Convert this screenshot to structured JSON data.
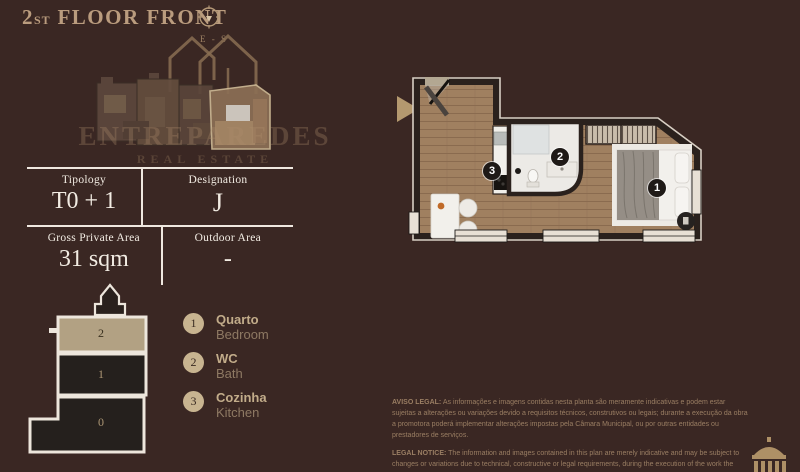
{
  "colors": {
    "background": "#3A2723",
    "gold": "#BA9C7E",
    "cream": "#F2ECE3",
    "legend_circle": "#C8B490",
    "current_floor_highlight": "#B2A183",
    "marker_background": "#1F1A17",
    "wood_floor": "#A08060"
  },
  "header": {
    "floor_number": "2",
    "floor_ordinal": "ST",
    "title": "FLOOR FRONT",
    "compass": {
      "icon": "compass-icon",
      "orientation_label": "E - S"
    }
  },
  "brand": {
    "name": "ENTREPAREDES",
    "tagline": "REAL ESTATE"
  },
  "unit_info": {
    "rows": [
      [
        {
          "label": "Tipology",
          "value": "T0 + 1"
        },
        {
          "label": "Designation",
          "value": "J"
        }
      ],
      [
        {
          "label": "Gross Private Area",
          "value": "31 sqm"
        },
        {
          "label": "Outdoor Area",
          "value": "-"
        }
      ]
    ]
  },
  "building_section": {
    "floors": [
      {
        "label": "2",
        "current": true
      },
      {
        "label": "1",
        "current": false
      },
      {
        "label": "0",
        "current": false
      }
    ]
  },
  "legend": {
    "items": [
      {
        "number": "1",
        "name_pt": "Quarto",
        "name_en": "Bedroom"
      },
      {
        "number": "2",
        "name_pt": "WC",
        "name_en": "Bath"
      },
      {
        "number": "3",
        "name_pt": "Cozinha",
        "name_en": "Kitchen"
      }
    ]
  },
  "floor_plan": {
    "markers": [
      {
        "number": "1"
      },
      {
        "number": "2"
      },
      {
        "number": "3"
      }
    ]
  },
  "legal": {
    "pt_label": "AVISO LEGAL:",
    "pt_text": " As informações e imagens contidas nesta planta são meramente indicativas e podem estar sujeitas a alterações ou variações devido a requisitos técnicos, construtivos ou legais; durante a execução da obra a promotora poderá implementar alterações impostas pela Câmara Municipal, ou por outras entidades ou prestadores de serviços.",
    "en_label": "LEGAL NOTICE:",
    "en_text": " The information and images contained in this plan are merely indicative and may be subject to changes or variations due to technical, constructive or legal requirements, during the execution of the work the developer may have to implement changes imposed by the City Council, or other entities or service providers."
  }
}
